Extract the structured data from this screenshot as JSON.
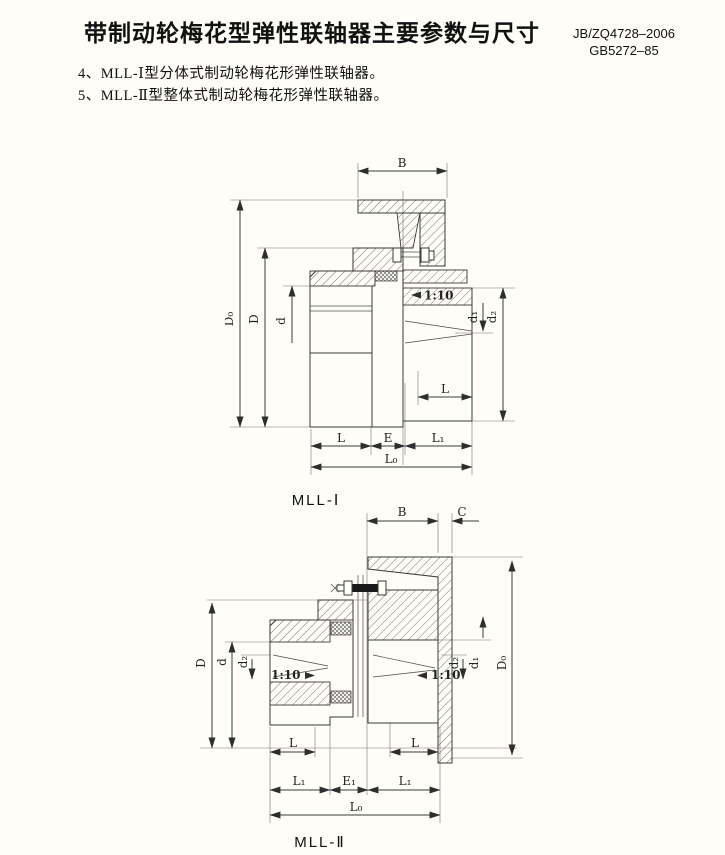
{
  "page": {
    "title": "带制动轮梅花型弹性联轴器主要参数与尺寸",
    "standard_line1": "JB/ZQ4728–2006",
    "standard_line2": "GB5272–85",
    "note4": "4、MLL-Ⅰ型分体式制动轮梅花形弹性联轴器。",
    "note5": "5、MLL-Ⅱ型整体式制动轮梅花形弹性联轴器。"
  },
  "figure1": {
    "caption": "MLL-Ⅰ",
    "dims": {
      "B": "B",
      "D0": "D₀",
      "D": "D",
      "d": "d",
      "taper": "1:10",
      "d1": "d₁",
      "d2": "d₂",
      "L_hub_right": "L",
      "L": "L",
      "E": "E",
      "L1": "L₁",
      "L0": "L₀"
    }
  },
  "figure2": {
    "caption": "MLL-Ⅱ",
    "dims": {
      "B": "B",
      "C": "C",
      "D0": "D₀",
      "D": "D",
      "d": "d",
      "d2_left": "d₂",
      "taper_left": "1:10",
      "taper_right": "1:10",
      "d2_right": "d₂",
      "d1": "d₁",
      "L_left": "L",
      "L_right": "L",
      "L1_left": "L₁",
      "E1": "E₁",
      "L1_right": "L₁",
      "L0": "L₀"
    }
  }
}
